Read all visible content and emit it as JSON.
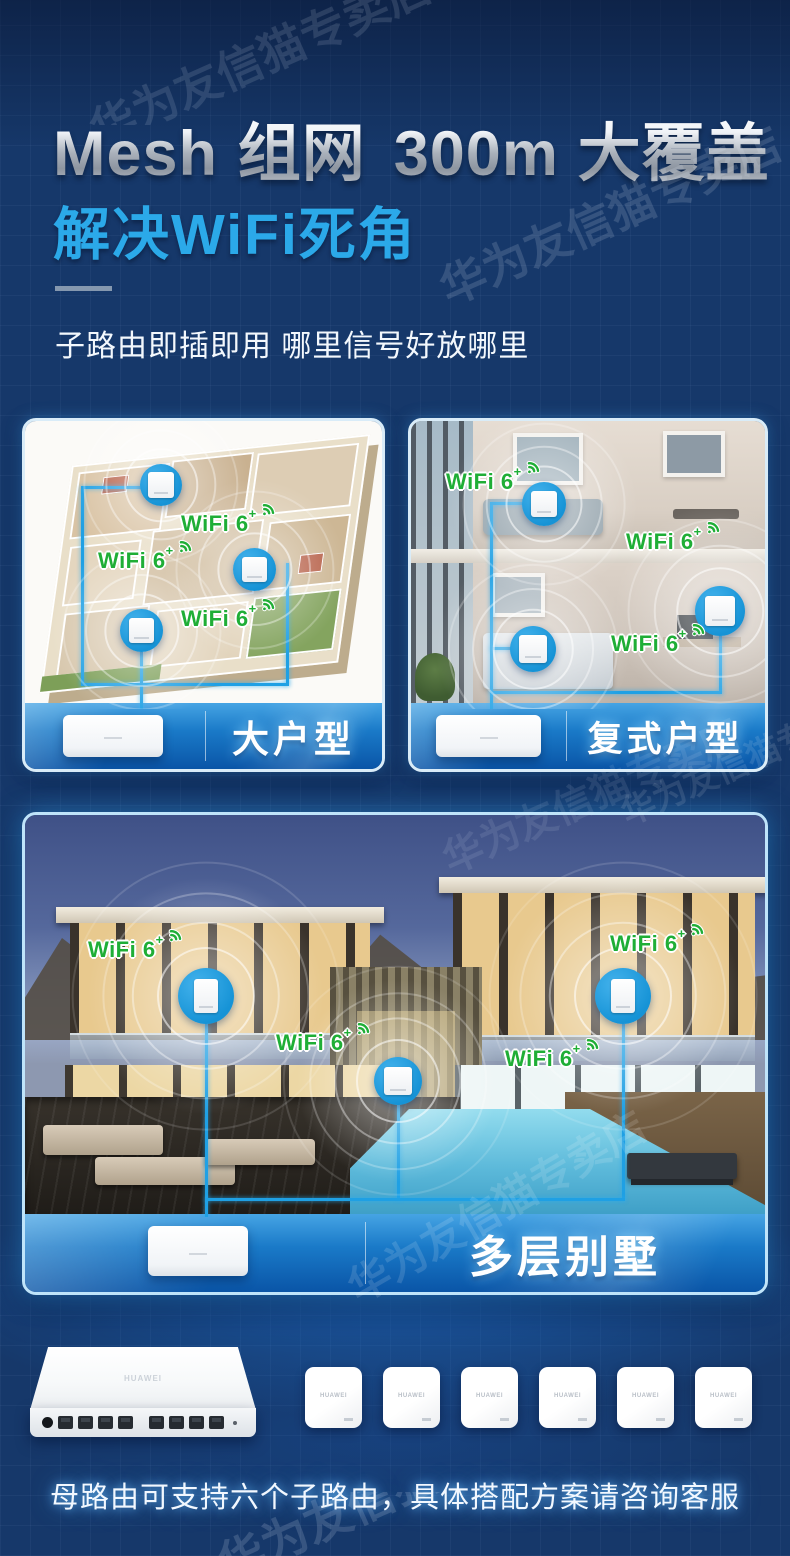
{
  "watermark": {
    "text": "华为友信猫专卖店"
  },
  "colors": {
    "background": "#16386A",
    "accent_cyan": "#2BA9E9",
    "line_blue": "#1FA0E4",
    "wifi_green": "#1FAE36",
    "bar_blue_top": "#46A4E4",
    "bar_blue_bottom": "#0A55A7"
  },
  "header": {
    "title": {
      "brand": "Mesh",
      "brand_sup": "+",
      "t1": "组网",
      "t2": "300m",
      "t2_sup": "2",
      "t3": "大覆盖"
    },
    "subtitle": "解决WiFi死角",
    "tagline": "子路由即插即用 哪里信号好放哪里"
  },
  "wifi_label": {
    "text": "WiFi 6",
    "sup": "+"
  },
  "cards": {
    "large_home": {
      "label": "大户型"
    },
    "duplex": {
      "label": "复式户型"
    },
    "villa": {
      "label": "多层别墅"
    }
  },
  "products": {
    "brand": "HUAWEI",
    "panel_count": 6
  },
  "footer": {
    "note": "母路由可支持六个子路由，具体搭配方案请咨询客服"
  }
}
